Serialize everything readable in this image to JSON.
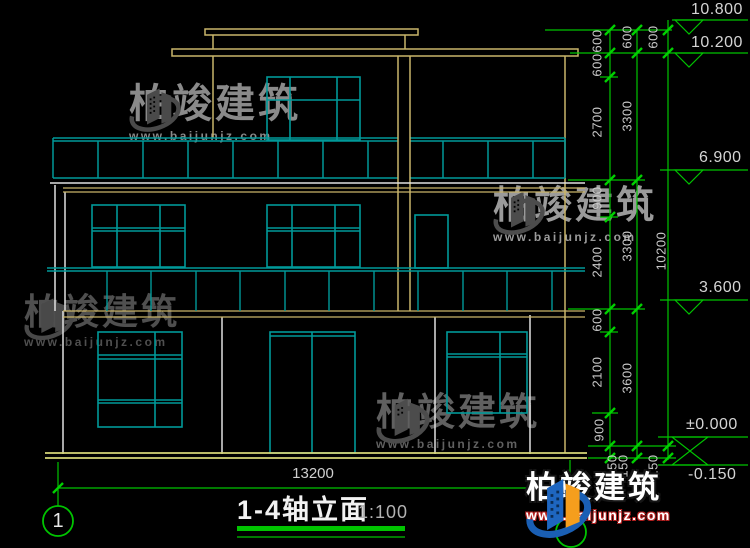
{
  "drawing": {
    "title": "1-4轴立面",
    "scale": "1:100",
    "axis_start": "1",
    "bottom_dim": "13200",
    "dims_detail": [
      "600",
      "600",
      "2700",
      "900",
      "2400",
      "600",
      "2100",
      "900",
      "150",
      "150"
    ],
    "dims_floor": [
      "600",
      "3300",
      "3300",
      "3600"
    ],
    "dims_overall": [
      "600",
      "10200",
      "150"
    ],
    "elevations": [
      "10.800",
      "10.200",
      "6.900",
      "3.600",
      "±0.000",
      "-0.150"
    ]
  },
  "watermark": {
    "brand": "柏竣建筑",
    "url": "www.baijunjz.com"
  },
  "colors": {
    "window_lines": "#009999",
    "wall_lines": "#c9b56a",
    "dim_lines": "#00c400",
    "white_lines": "#e0e0e0",
    "ground": "#d6d677",
    "logo_blue": "#1a5fb4",
    "logo_orange": "#f59e1d"
  }
}
